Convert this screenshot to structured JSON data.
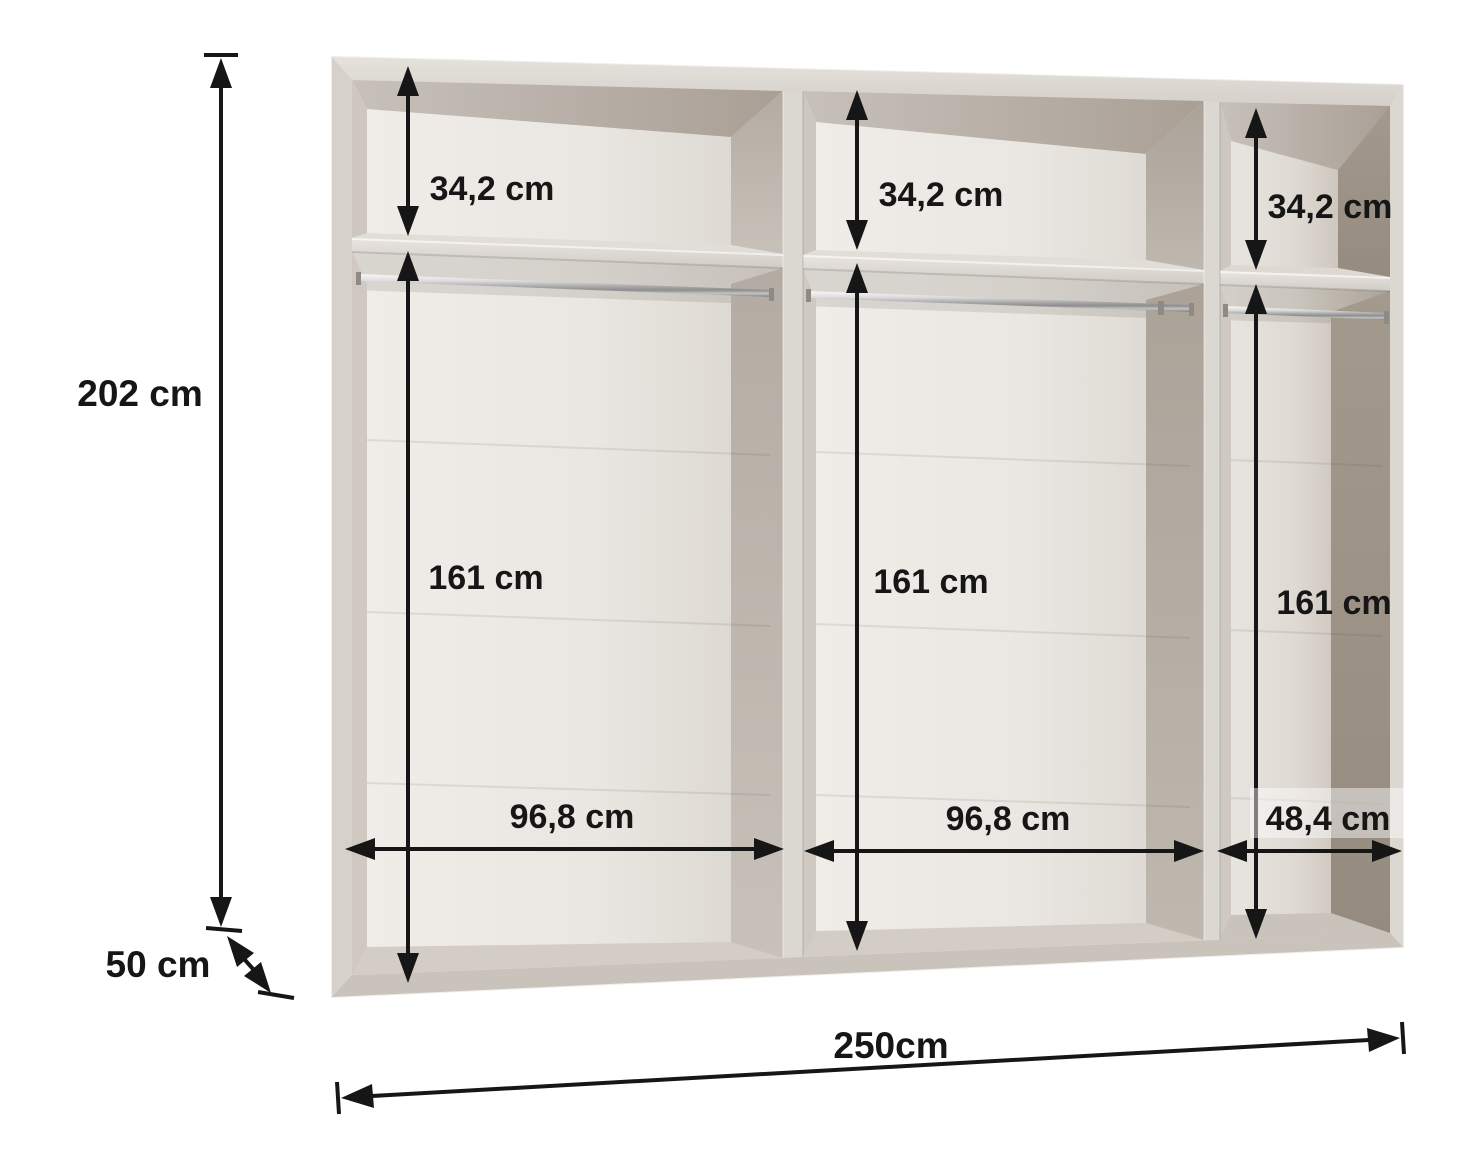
{
  "diagram": {
    "kind": "wardrobe-interior-dimension-drawing",
    "units": "cm",
    "overall": {
      "height": "202 cm",
      "depth": "50 cm",
      "width": "250cm"
    },
    "sections": [
      {
        "name": "left",
        "upper_shelf_height": "34,2 cm",
        "hanging_area_height": "161 cm",
        "inner_width": "96,8 cm"
      },
      {
        "name": "middle",
        "upper_shelf_height": "34,2 cm",
        "hanging_area_height": "161 cm",
        "inner_width": "96,8 cm"
      },
      {
        "name": "right",
        "upper_shelf_height": "34,2 cm",
        "hanging_area_height": "161 cm",
        "inner_width": "48,4 cm"
      }
    ],
    "colors": {
      "annotation": "#161616",
      "frame_light": "#dbd7d1",
      "back_panel": "#ebe8e4",
      "interior_shadow": "#a3998d",
      "rail_chrome": "#c9c9c9",
      "background": "#ffffff"
    }
  }
}
